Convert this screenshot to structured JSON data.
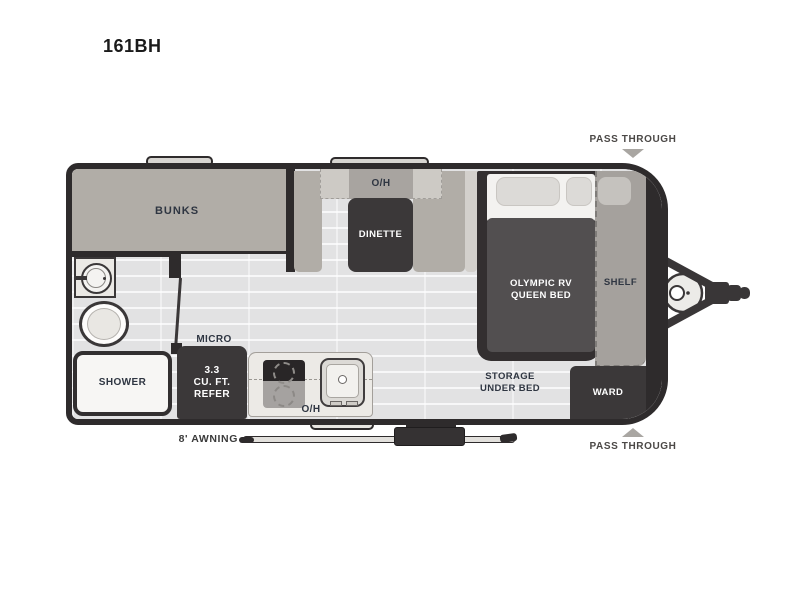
{
  "title": "161BH",
  "floorplan": {
    "bunks": "BUNKS",
    "overhead_dinette": "O/H",
    "dinette": "DINETTE",
    "bed_line1": "OLYMPIC RV",
    "bed_line2": "QUEEN BED",
    "shelf": "SHELF",
    "storage_line1": "STORAGE",
    "storage_line2": "UNDER BED",
    "ward": "WARD",
    "shower": "SHOWER",
    "micro": "MICRO",
    "refer_line1": "3.3",
    "refer_line2": "CU. FT.",
    "refer_line3": "REFER",
    "overhead_kitchen": "O/H"
  },
  "callouts": {
    "pass_through_top": "PASS THROUGH",
    "pass_through_bottom": "PASS THROUGH",
    "awning": "8' AWNING"
  },
  "colors": {
    "outline": "#2e2b2c",
    "dark_furniture": "#3b3839",
    "gray_furniture": "#b1ada7",
    "shelf_gray": "#a5a19d",
    "floor_light": "#e6e6e7",
    "label_dark": "#2f3642",
    "callout_gray": "#4b4846",
    "arrow_gray": "#a9a6a2"
  }
}
